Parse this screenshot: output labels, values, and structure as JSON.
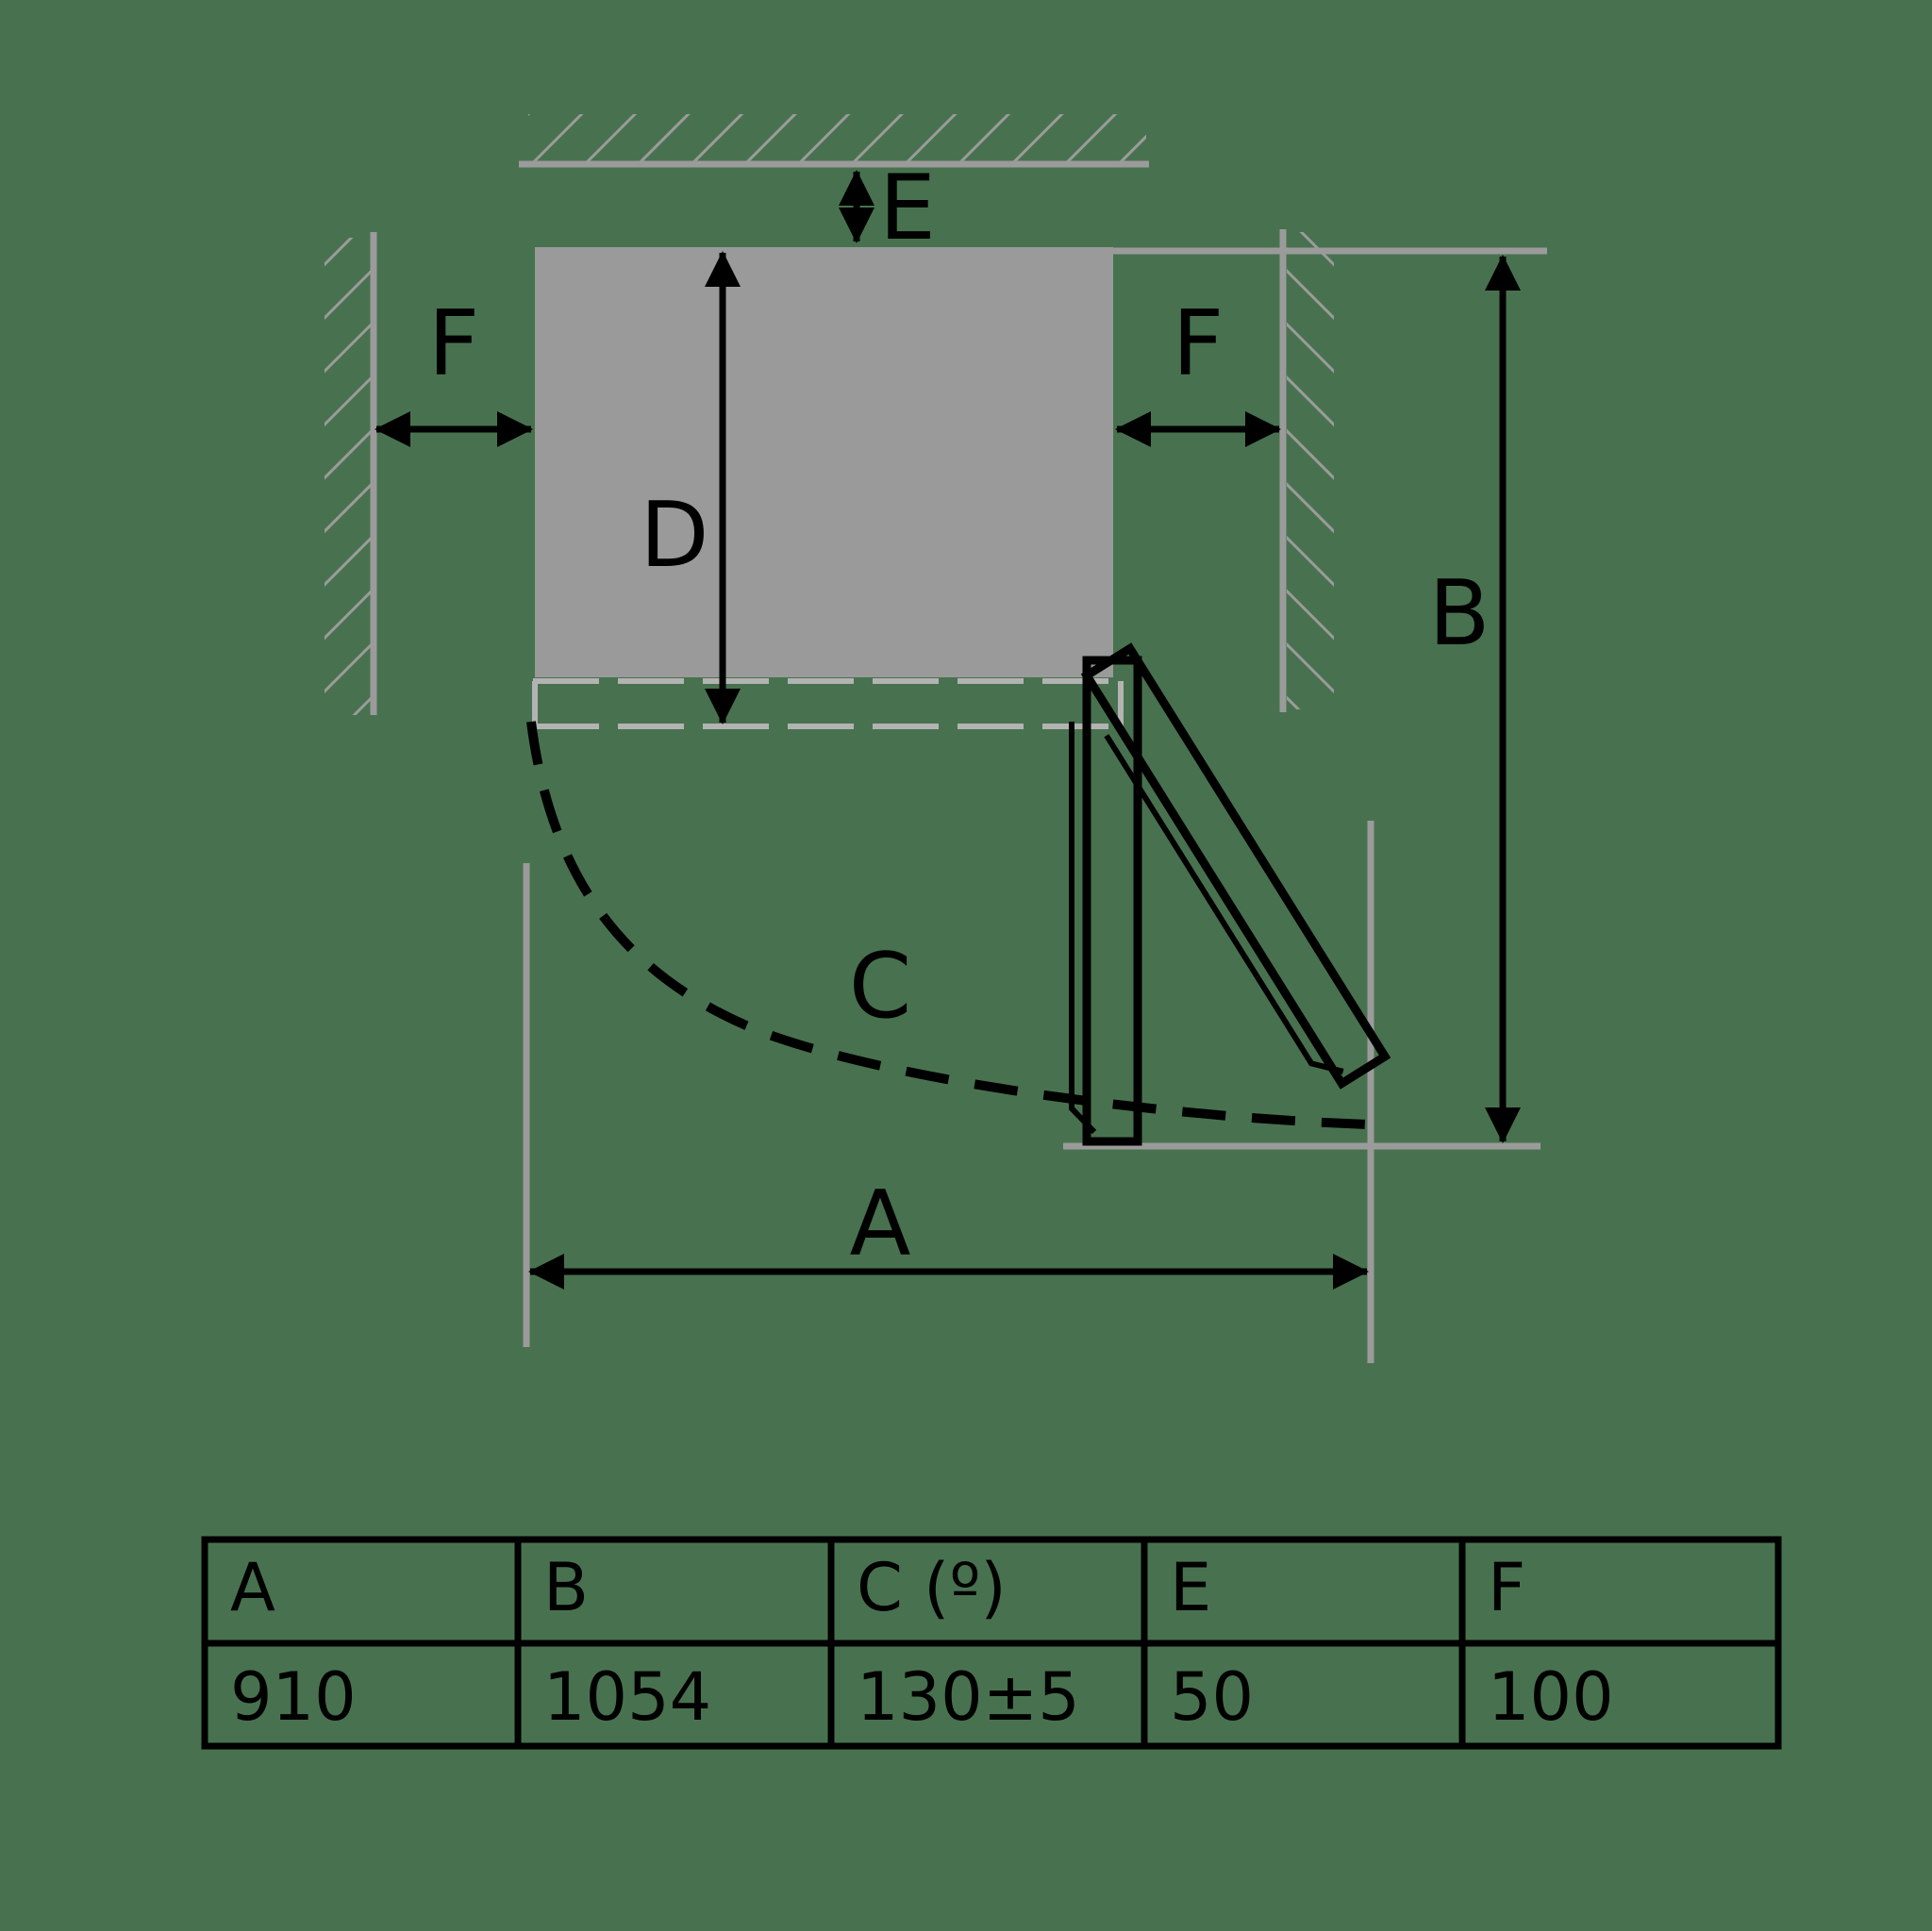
{
  "colors": {
    "background": "#48724F",
    "structure_gray": "#9B9B9B",
    "cabinet_fill": "#9A9A9A",
    "closed_door_dash_gray": "#B3B3B3",
    "ink": "#000000"
  },
  "diagram": {
    "labels": {
      "a": "A",
      "b": "B",
      "c": "C",
      "d": "D",
      "e": "E",
      "f_left": "F",
      "f_right": "F"
    }
  },
  "table": {
    "headers": [
      "A",
      "B",
      "C (º)",
      "E",
      "F"
    ],
    "values": [
      "910",
      "1054",
      "130±5",
      "50",
      "100"
    ]
  }
}
